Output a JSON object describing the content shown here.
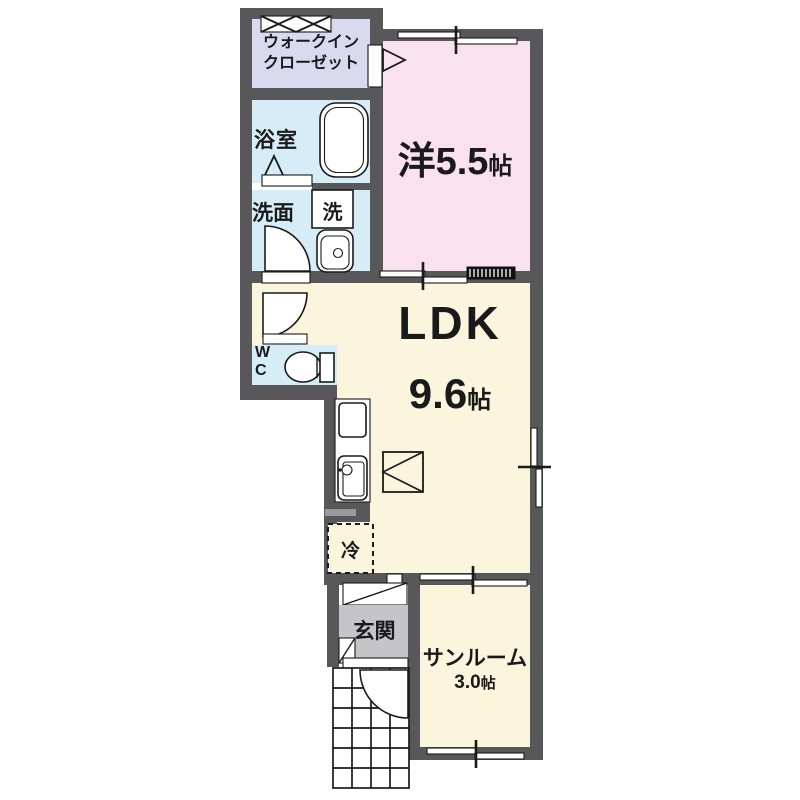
{
  "colors": {
    "wall": "#58585a",
    "closet": "#d9d9ef",
    "water": "#d6edf7",
    "western": "#f9e2ee",
    "living": "#fbf5dd",
    "entrance_floor": "#c5c5c7",
    "line": "#1a1a1a"
  },
  "rooms": {
    "walk_in_closet": {
      "line1": "ウォークイン",
      "line2": "クローゼット"
    },
    "bathroom": {
      "label": "浴室"
    },
    "washroom": {
      "label": "洗面"
    },
    "washer": {
      "label": "洗"
    },
    "western_room": {
      "name": "洋",
      "size": "5.5",
      "unit": "帖"
    },
    "ldk": {
      "name": "LDK",
      "size": "9.6",
      "unit": "帖"
    },
    "wc": {
      "line1": "W",
      "line2": "C"
    },
    "refrigerator": {
      "label": "冷"
    },
    "entrance": {
      "label": "玄関"
    },
    "sunroom": {
      "name": "サンルーム",
      "size": "3.0",
      "unit": "帖"
    }
  }
}
